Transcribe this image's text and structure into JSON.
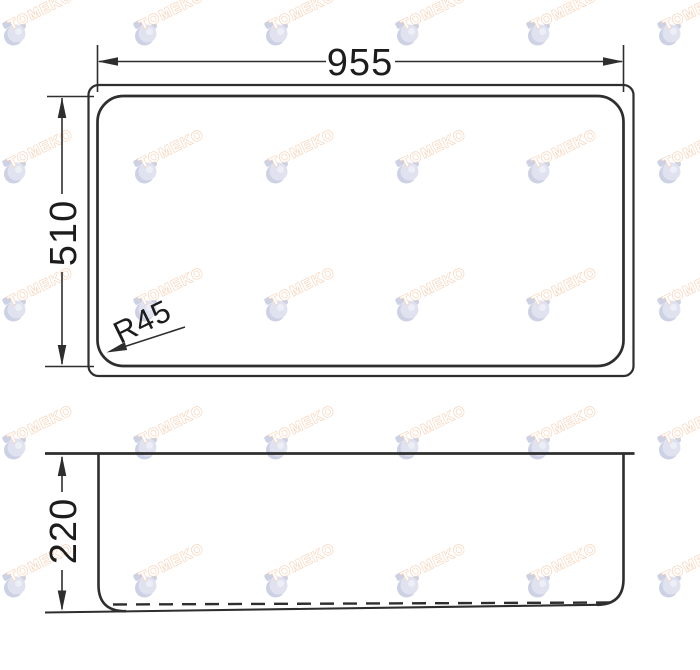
{
  "watermark": {
    "text": "TOMEKO",
    "text_stroke": "#efa770",
    "icon_color": "#c7cbe4",
    "icon_shade": "#a5abce",
    "icon_light": "#dfe2f0"
  },
  "colors": {
    "line": "#2e2e2e",
    "dim_text": "#1c1c1c",
    "background": "#ffffff"
  },
  "top_view": {
    "width_dim_label": "955",
    "height_dim_label": "510",
    "corner_radius_label": "R45",
    "width_value": 955,
    "height_value": 510,
    "corner_radius_value": 45
  },
  "side_view": {
    "depth_dim_label": "220",
    "depth_value": 220
  }
}
